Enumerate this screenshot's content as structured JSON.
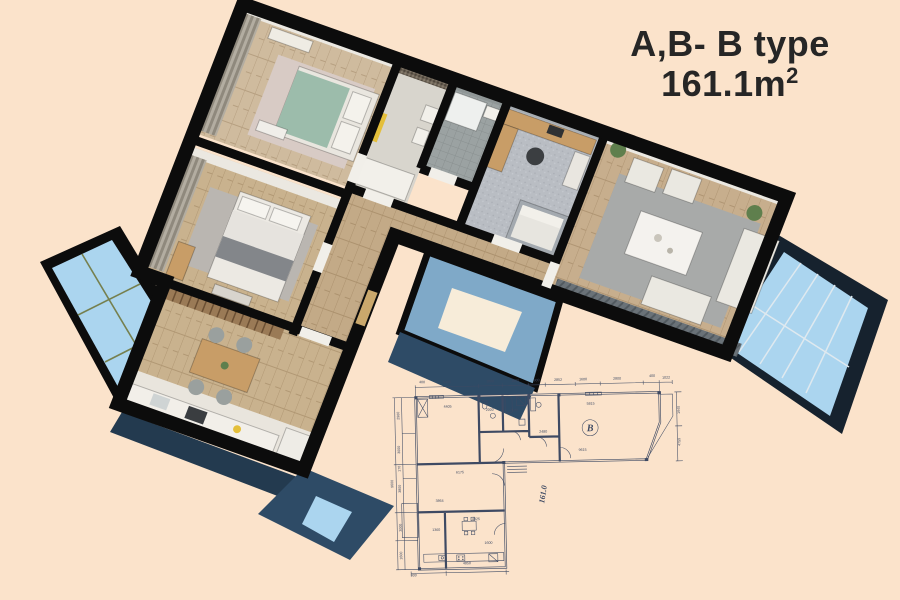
{
  "title": {
    "type_label": "A,B- B type",
    "area": "161.1m",
    "area_exponent": "2"
  },
  "blueprint": {
    "unit_label": "B",
    "area_label": "161.0",
    "dims": [
      {
        "text": "400",
        "x": 37,
        "y": 8
      },
      {
        "text": "5405",
        "x": 62,
        "y": 8.5
      },
      {
        "text": "1000",
        "x": 105,
        "y": 8.5
      },
      {
        "text": "1800",
        "x": 130,
        "y": 8.5
      },
      {
        "text": "900",
        "x": 151.5,
        "y": 8.5
      },
      {
        "text": "2852",
        "x": 173,
        "y": 8.5
      },
      {
        "text": "1600",
        "x": 198,
        "y": 8.5
      },
      {
        "text": "2800",
        "x": 232,
        "y": 8.5
      },
      {
        "text": "400",
        "x": 267,
        "y": 6.5
      },
      {
        "text": "1022",
        "x": 281,
        "y": 8.5
      },
      {
        "text": "9600",
        "x": 6,
        "y": 108,
        "rot": -90
      },
      {
        "text": "2960",
        "x": 13.5,
        "y": 40,
        "rot": -90
      },
      {
        "text": "3000",
        "x": 13.5,
        "y": 74,
        "rot": -90
      },
      {
        "text": "170",
        "x": 13.5,
        "y": 93,
        "rot": -90
      },
      {
        "text": "3800",
        "x": 13.5,
        "y": 113,
        "rot": -90
      },
      {
        "text": "3000",
        "x": 13.5,
        "y": 152,
        "rot": -90
      },
      {
        "text": "1600",
        "x": 13.5,
        "y": 180,
        "rot": -90
      },
      {
        "text": "300",
        "x": 24.5,
        "y": 201
      },
      {
        "text": "1940",
        "x": 294,
        "y": 40,
        "rot": -90
      },
      {
        "text": "4759",
        "x": 294,
        "y": 72,
        "rot": -90
      },
      {
        "text": "4405",
        "x": 62,
        "y": 33
      },
      {
        "text": "2000",
        "x": 104,
        "y": 37
      },
      {
        "text": "7100",
        "x": 128,
        "y": 38
      },
      {
        "text": "5815",
        "x": 205,
        "y": 33
      },
      {
        "text": "2480",
        "x": 157,
        "y": 60
      },
      {
        "text": "9615",
        "x": 196,
        "y": 79
      },
      {
        "text": "6175",
        "x": 73,
        "y": 99
      },
      {
        "text": "3864",
        "x": 52,
        "y": 127
      },
      {
        "text": "4925",
        "x": 88,
        "y": 146
      },
      {
        "text": "1360",
        "x": 48,
        "y": 156
      },
      {
        "text": "1600",
        "x": 100,
        "y": 170
      },
      {
        "text": "4850",
        "x": 78,
        "y": 190
      }
    ]
  },
  "palette": {
    "background": "#fbe3cb",
    "wall": "#0c0c0c",
    "ink": "#3e4a63",
    "title_color": "#262626",
    "wood": "#c9b28e",
    "wood_light": "#cfbb9e",
    "wood_mid": "#c3aa87",
    "wood_living": "#c7ae8d",
    "glass": "#abd5ef",
    "glass_deep": "#7fa9c8",
    "navy_face": "#2e4b66",
    "rug_gray": "#a8aaa9",
    "rug_pink": "#d8cbc5",
    "rug_soft": "#bab6b1",
    "bed_green": "#9cbcab",
    "furniture_white": "#eae8e1",
    "carpet": "#b9bdc3",
    "tile_gray": "#9ba2a2",
    "tile_light": "#d8d5cd",
    "accent_yellow": "#e4bf3a",
    "counter_wood": "#c89d67",
    "plant_green": "#5f7f4d",
    "blinds": "#6a7278",
    "slat_brown": "#9a7a56",
    "terrace_cream": "#f7ecd9"
  }
}
